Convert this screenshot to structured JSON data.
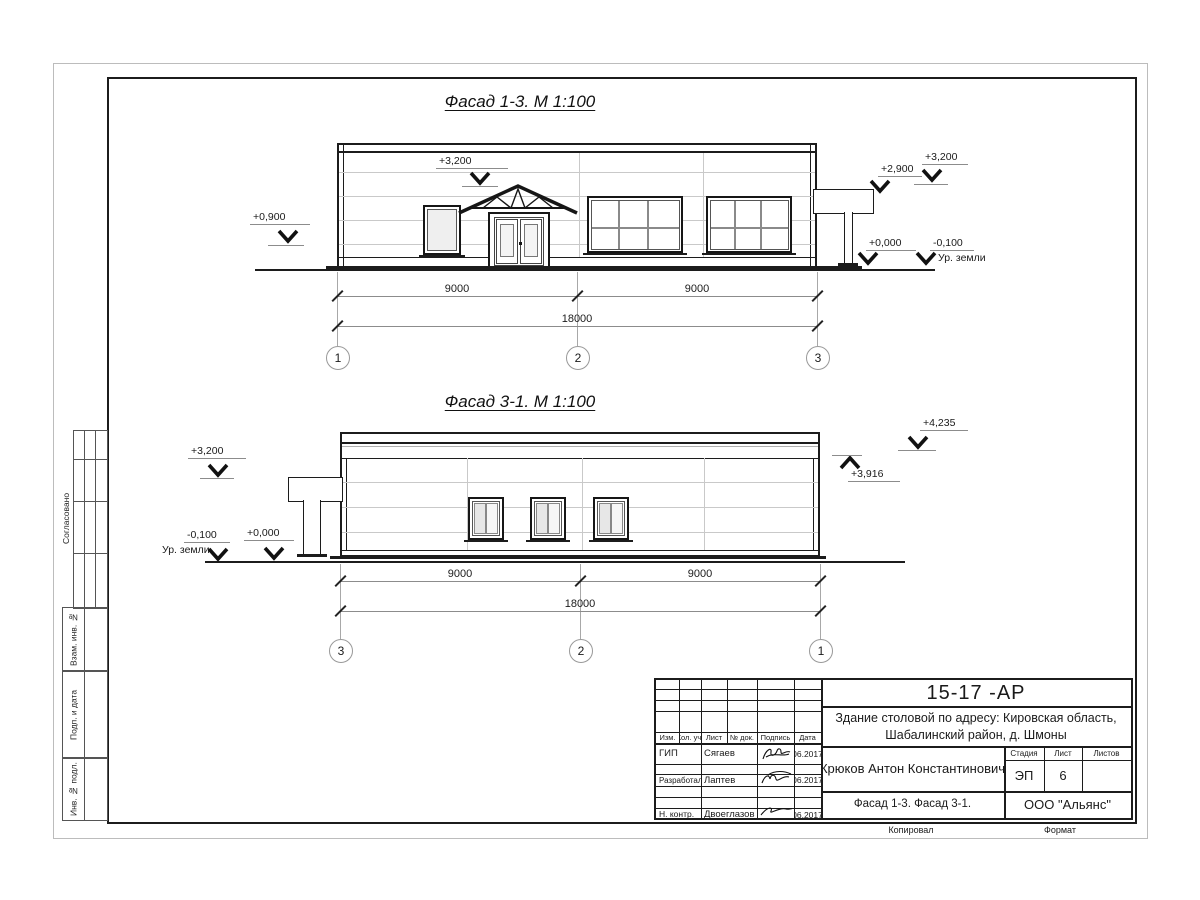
{
  "facade1": {
    "title": "Фасад 1-3.  М 1:100",
    "levels": {
      "parapet": "+3,200",
      "left": "+0,900",
      "canopy": "+2,900",
      "right_top": "+3,200",
      "zero": "+0,000",
      "ground_lvl": "-0,100",
      "ground_label": "Ур. земли"
    },
    "dim_left": "9000",
    "dim_right": "9000",
    "dim_total": "18000",
    "axes": [
      "1",
      "2",
      "3"
    ]
  },
  "facade2": {
    "title": "Фасад 3-1.  М 1:100",
    "levels": {
      "parapet": "+3,200",
      "ground_lvl": "-0,100",
      "ground_label": "Ур. земли",
      "zero": "+0,000",
      "top": "+4,235",
      "roof": "+3,916"
    },
    "dim_left": "9000",
    "dim_right": "9000",
    "dim_total": "18000",
    "axes": [
      "3",
      "2",
      "1"
    ]
  },
  "sidebar": {
    "agreed": "Согласовано",
    "box1": "Взам. инв. №",
    "box2": "Подп. и дата",
    "box3": "Инв. № подл."
  },
  "titleblock": {
    "doc_number": "15-17 -АР",
    "project_line1": "Здание столовой по адресу: Кировская область,",
    "project_line2": "Шабалинский район, д. Шмоны",
    "columns": [
      "Изм.",
      "Кол. уч.",
      "Лист",
      "№ док.",
      "Подпись",
      "Дата"
    ],
    "rows": [
      {
        "role": "ГИП",
        "name": "Сягаев",
        "date": "06.2017"
      },
      {
        "role": "Разработал",
        "name": "Лаптев",
        "date": "06.2017"
      },
      {
        "role": "Н. контр.",
        "name": "Двоеглазов",
        "date": "06.2017"
      }
    ],
    "author": "Крюков Антон Константинович",
    "stage_label": "Стадия",
    "sheet_label": "Лист",
    "sheets_label": "Листов",
    "stage": "ЭП",
    "sheet_num": "6",
    "sheet_title": "Фасад 1-3. Фасад 3-1.",
    "org": "ООО \"Альянс\"",
    "copied": "Копировал",
    "format": "Формат"
  }
}
